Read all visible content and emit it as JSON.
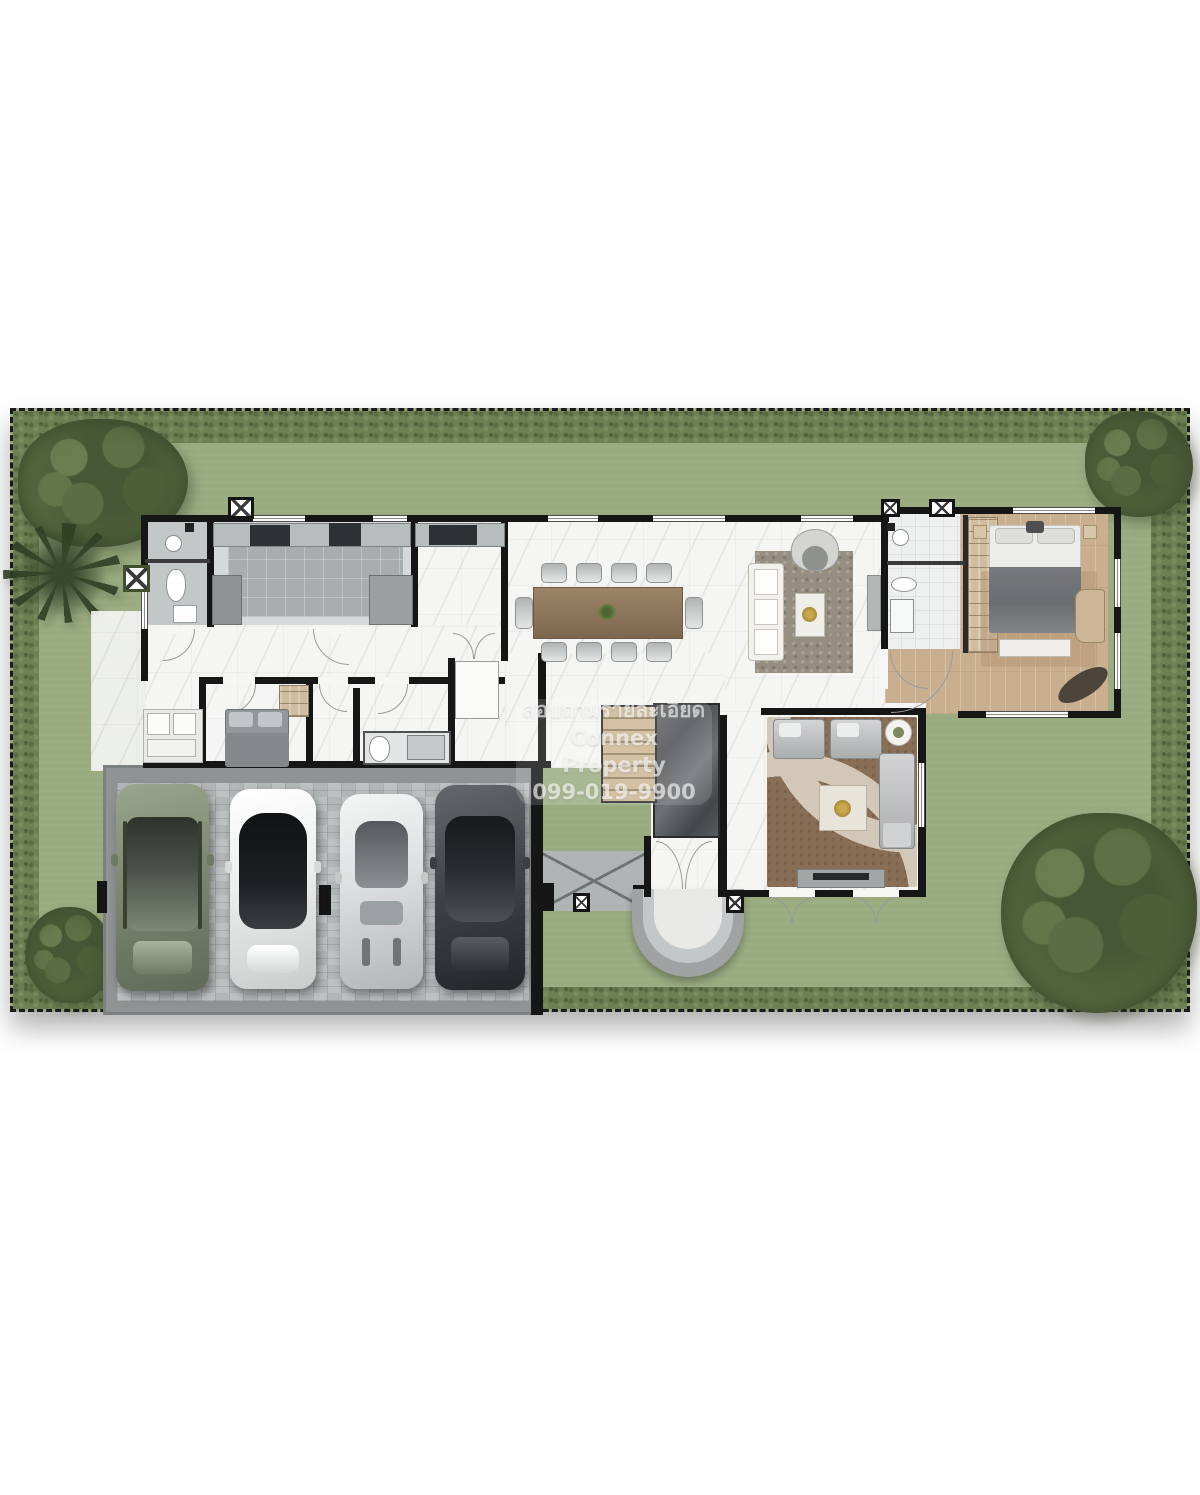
{
  "watermark": {
    "line1": "สอบถามรายละเอียด",
    "line2": "Connex Property",
    "line3": "099-019-9900"
  },
  "palette": {
    "lawn": "#9aab80",
    "hedge": "#6d7f53",
    "wall": "#161616",
    "marble_floor": "#f5f5f3",
    "wood_floor": "#c9af90",
    "garage_paver": "#b9bdbe",
    "rug_living": "#968e80",
    "rug_family": "#8a6f57",
    "boundary_style": "dashed-black"
  },
  "landscape": {
    "trees": [
      "large-tree-top-left",
      "palm-tree-top-left",
      "small-tree-bottom-left",
      "large-tree-bottom-right",
      "tree-top-right"
    ]
  },
  "house": {
    "rooms": [
      "bathroom-1",
      "kitchen",
      "pantry",
      "dining-area",
      "living-area",
      "master-bathroom",
      "wardrobe",
      "master-bedroom",
      "hallway",
      "bedroom-2",
      "bathroom-2",
      "closet",
      "stairs",
      "foyer",
      "family-room",
      "terrace",
      "entrance-porch",
      "garage",
      "driveway-ramp"
    ]
  },
  "garage": {
    "cars": [
      {
        "type": "suv",
        "color": "sage-green"
      },
      {
        "type": "sedan",
        "color": "white-with-black-glass-roof"
      },
      {
        "type": "sports-car",
        "color": "silver-white"
      },
      {
        "type": "sedan",
        "color": "dark-grey"
      }
    ]
  }
}
